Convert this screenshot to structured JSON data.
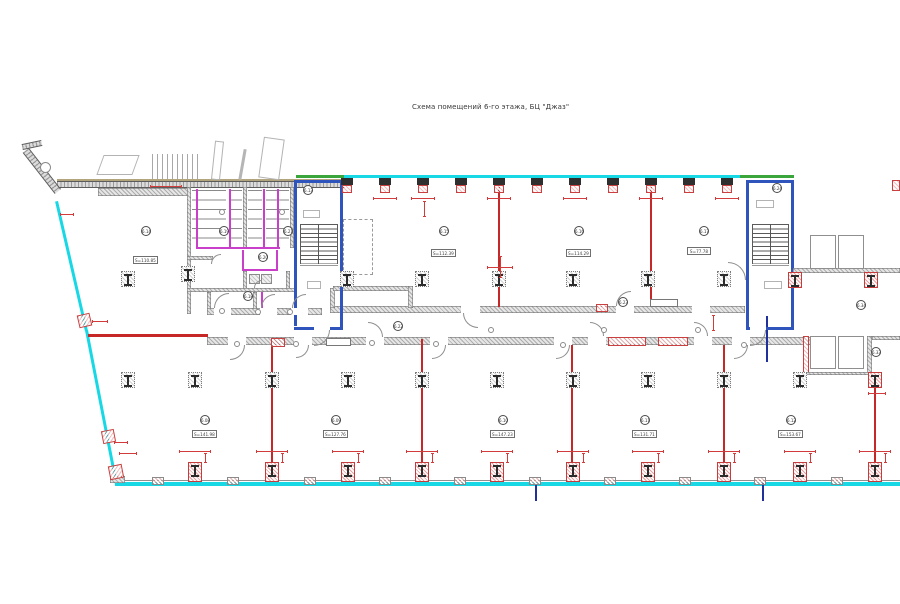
{
  "title": "Схема помещений 6-го этажа, БЦ \"Джаз\"",
  "rooms": {
    "upper": [
      {
        "number": "6.14",
        "area": "S=110.85"
      },
      {
        "number": "6.15",
        "area": "S=112.39"
      },
      {
        "number": "6.16",
        "area": "S=114.29"
      },
      {
        "number": "6.17",
        "area": "S=77.78"
      }
    ],
    "lower": [
      {
        "number": "6.08",
        "area": "S=141.98"
      },
      {
        "number": "6.09",
        "area": "S=127.76"
      },
      {
        "number": "6.10",
        "area": "S=147.23"
      },
      {
        "number": "6.11",
        "area": "S=131.71"
      },
      {
        "number": "6.12",
        "area": "S=153.67"
      }
    ],
    "stairwells": [
      {
        "number": "6.13"
      },
      {
        "number": "6.24"
      }
    ],
    "sanitary": [
      {
        "number": "6.19"
      },
      {
        "number": "6.20"
      },
      {
        "number": "6.21"
      },
      {
        "number": "6.18"
      }
    ],
    "corridor": [
      {
        "number": "6.22"
      },
      {
        "number": "6.23"
      }
    ],
    "right_side": [
      {
        "number": "6.34"
      },
      {
        "number": "6.33"
      }
    ]
  },
  "colors": {
    "exterior_wall": "#17d8e4",
    "new_partition": "#c62828",
    "plumbing_partition": "#c93fc9",
    "stairwell_wall": "#2f55bd",
    "window_band": "#3aa53a",
    "existing_wall": "#8d8d8d",
    "dimension": "#d23b3b"
  }
}
